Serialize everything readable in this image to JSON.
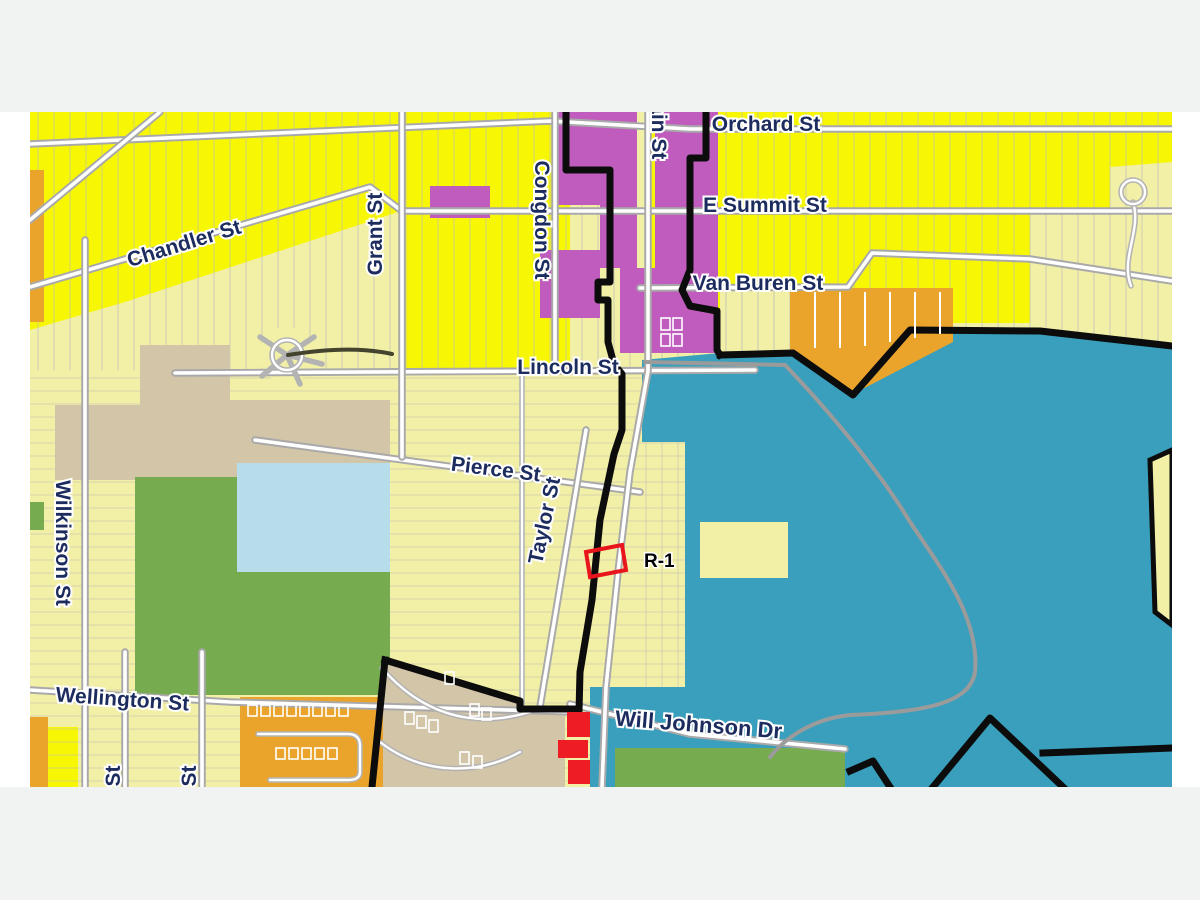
{
  "page": {
    "background": "#f1f2f2",
    "map_background": "#ffffff"
  },
  "map": {
    "street_labels": {
      "orchard": "Orchard St",
      "e_summit": "E Summit St",
      "van_buren": "Van Buren St",
      "lincoln": "Lincoln St",
      "pierce": "Pierce St",
      "chandler": "Chandler St",
      "grant": "Grant St",
      "congdon": "Congdon St",
      "main": "Main St",
      "taylor": "Taylor St",
      "wilkinson": "Wilkinson St",
      "wellington": "Wellington St",
      "will_johnson": "Will Johnson Dr",
      "st_partial_1": "St",
      "st_partial_2": "St"
    },
    "annotations": {
      "r1_label": "R-1"
    },
    "palette": {
      "parcel_yellow_bright": "#f7f704",
      "parcel_yellow_pale": "#f2efa7",
      "zone_purple": "#c05cbe",
      "zone_orange": "#eaa42c",
      "zone_teal": "#399fbc",
      "zone_green": "#76ab50",
      "zone_light_blue": "#b7dcea",
      "zone_tan": "#d3c5a8",
      "highlight_red": "#ee1c23",
      "boundary_black": "#0c0c0c",
      "road_gray": "#a9a9a9",
      "label_navy": "#1d2c5e"
    }
  }
}
